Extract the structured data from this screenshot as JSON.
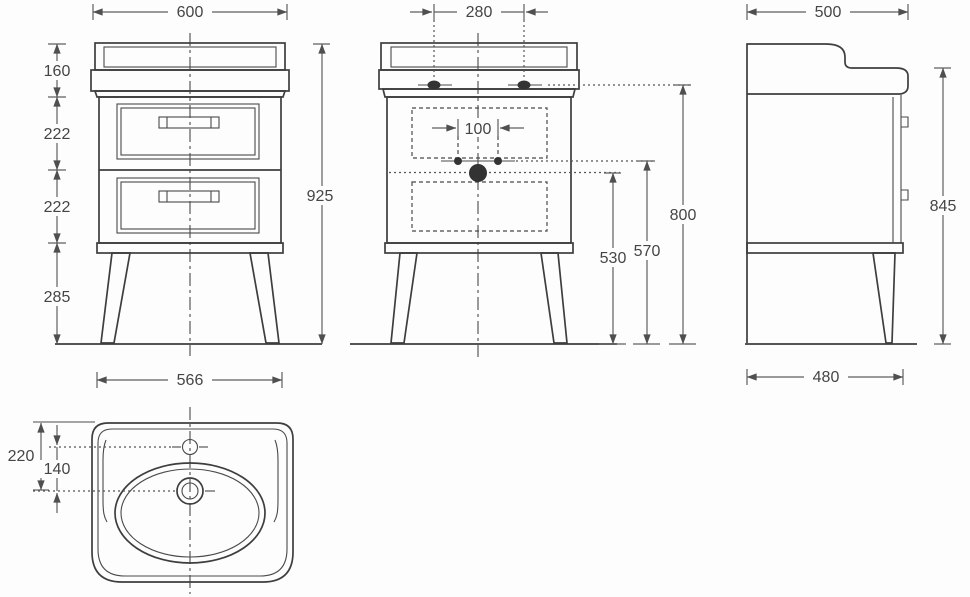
{
  "front_view": {
    "width": "600",
    "height": "925",
    "segments": {
      "top": "160",
      "drawer_upper": "222",
      "drawer_lower": "222",
      "legs": "285"
    },
    "feet_width": "566"
  },
  "back_view": {
    "fixing_span": "280",
    "tap_hole_span": "100",
    "fixing_height": "800",
    "supply_height": "570",
    "drain_height": "530"
  },
  "side_view": {
    "depth": "500",
    "front_height": "845",
    "feet_depth": "480"
  },
  "basin_view": {
    "edge_to_drain": "220",
    "tap_to_drain": "140"
  }
}
